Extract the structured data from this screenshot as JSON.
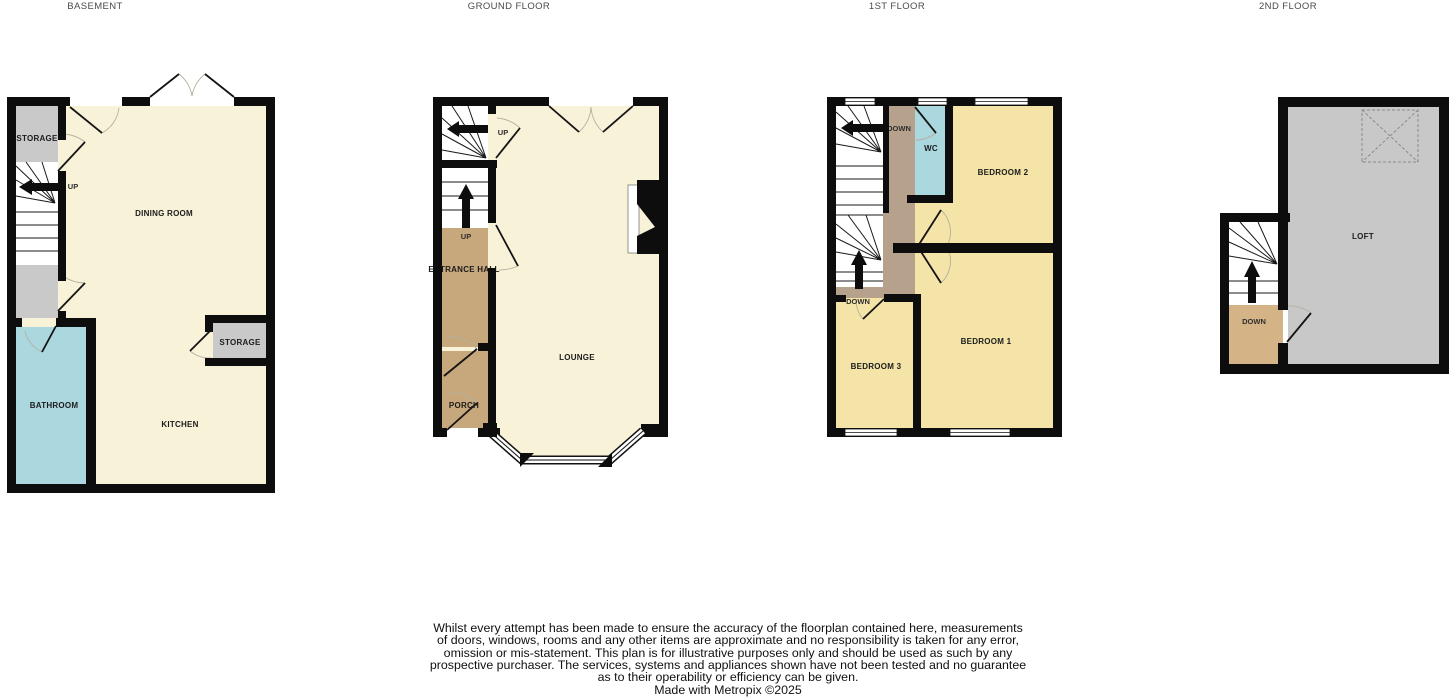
{
  "floors": {
    "basement": {
      "title": "BASEMENT",
      "rooms": {
        "storage_left": "STORAGE",
        "dining_room": "DINING ROOM",
        "bathroom": "BATHROOM",
        "kitchen": "KITCHEN",
        "storage_right": "STORAGE"
      },
      "stairs": {
        "up_label": "UP"
      }
    },
    "ground": {
      "title": "GROUND FLOOR",
      "rooms": {
        "lounge": "LOUNGE",
        "entrance_hall": "ENTRANCE HALL",
        "porch": "PORCH"
      },
      "stairs": {
        "up_label_top": "UP",
        "up_label_mid": "UP"
      }
    },
    "first": {
      "title": "1ST FLOOR",
      "rooms": {
        "wc": "WC",
        "bedroom1": "BEDROOM 1",
        "bedroom2": "BEDROOM 2",
        "bedroom3": "BEDROOM 3"
      },
      "stairs": {
        "down_label_top": "DOWN",
        "down_label_mid": "DOWN"
      }
    },
    "second": {
      "title": "2ND FLOOR",
      "rooms": {
        "loft": "LOFT"
      },
      "stairs": {
        "down_label": "DOWN"
      }
    }
  },
  "disclaimer": {
    "lines": [
      "Whilst every attempt has been made to ensure the accuracy of the floorplan contained here, measurements",
      "of doors, windows, rooms and any other items are approximate and no responsibility is taken for any error,",
      "omission or mis-statement. This plan is for illustrative purposes only and should be used as such by any",
      "prospective purchaser. The services, systems and appliances shown have not been tested and no guarantee",
      "as to their operability or efficiency can be given."
    ],
    "credit": "Made with Metropix ©2025"
  },
  "colors": {
    "wall": "#0d0d0d",
    "room_cream": "#f7f2d8",
    "room_yellow": "#f4e4a8",
    "room_gray": "#c9c9c9",
    "room_blue": "#abd7de",
    "room_tan": "#c7a77c",
    "landing_tan": "#b5a18c",
    "landing_sand": "#d4b386",
    "loft_gray": "#c8c8c8",
    "stair_white": "#ffffff"
  }
}
